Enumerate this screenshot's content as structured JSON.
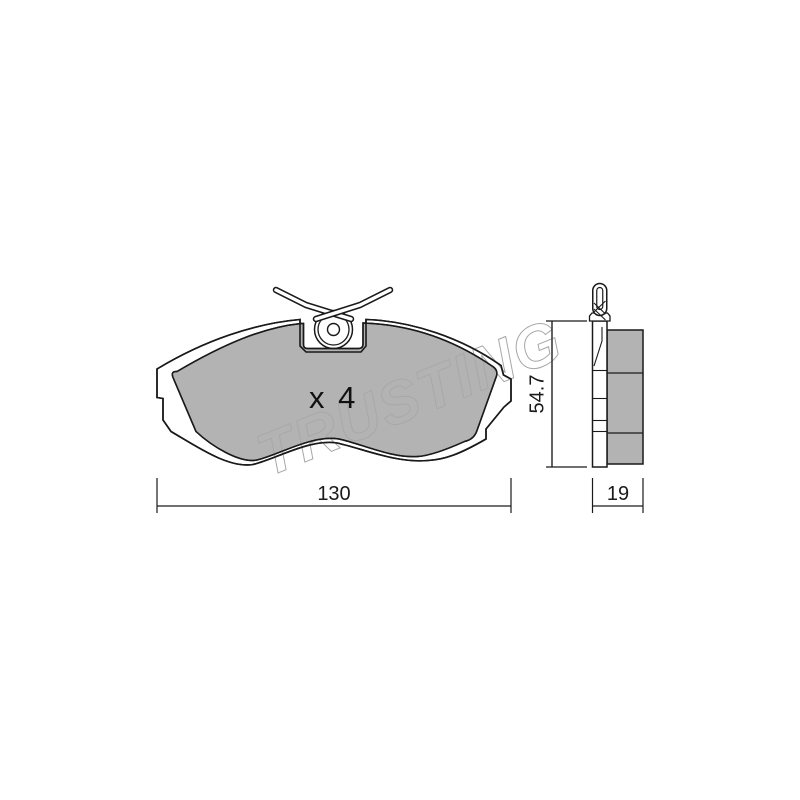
{
  "watermark": {
    "text": "TRUSTING",
    "color": "#a8a8a8"
  },
  "front_view": {
    "quantity_label": "x 4"
  },
  "dimensions": {
    "width": {
      "label": "130"
    },
    "height": {
      "label": "54.7"
    },
    "thickness": {
      "label": "19"
    }
  },
  "colors": {
    "line": "#1a1a1a",
    "friction_material": "#b3b3b3",
    "plate_fill": "#ffffff",
    "background": "#ffffff"
  }
}
